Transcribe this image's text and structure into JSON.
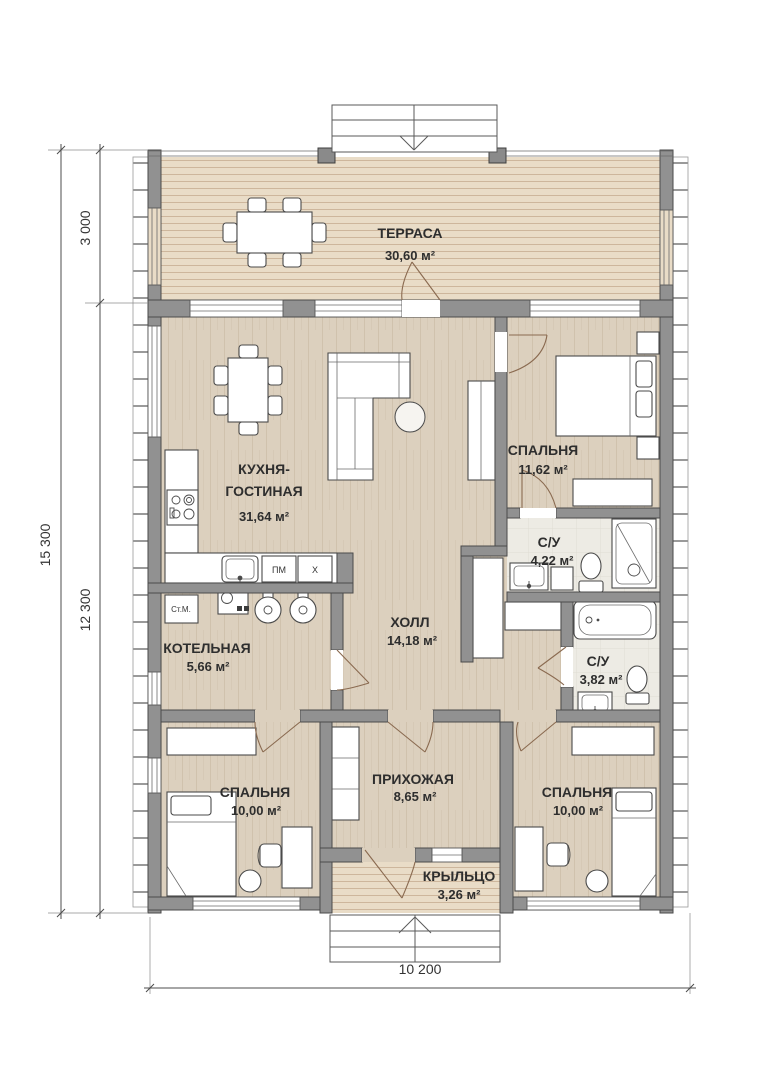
{
  "rooms": {
    "terrace": {
      "name": "ТЕРРАСА",
      "area": "30,60 м²"
    },
    "kitchen_living": {
      "name_line1": "КУХНЯ-",
      "name_line2": "ГОСТИНАЯ",
      "area": "31,64 м²"
    },
    "bedroom_master": {
      "name": "СПАЛЬНЯ",
      "area": "11,62 м²"
    },
    "bathroom_ensuite": {
      "name": "С/У",
      "area": "4,22 м²"
    },
    "hall": {
      "name": "ХОЛЛ",
      "area": "14,18 м²"
    },
    "boiler_room": {
      "name": "КОТЕЛЬНАЯ",
      "area": "5,66 м²"
    },
    "bathroom_main": {
      "name": "С/У",
      "area": "3,82 м²"
    },
    "bedroom_left": {
      "name": "СПАЛЬНЯ",
      "area": "10,00 м²"
    },
    "entry_hall": {
      "name": "ПРИХОЖАЯ",
      "area": "8,65 м²"
    },
    "bedroom_right": {
      "name": "СПАЛЬНЯ",
      "area": "10,00 м²"
    },
    "porch": {
      "name": "КРЫЛЬЦО",
      "area": "3,26 м²"
    }
  },
  "dimensions": {
    "overall_depth": "15 300",
    "terrace_depth": "3 000",
    "main_depth": "12 300",
    "overall_width": "10 200"
  },
  "appliances": {
    "dishwasher": "ПМ",
    "fridge": "Х",
    "washing_machine": "Ст.М."
  },
  "colors": {
    "wall": "#919191",
    "wall_stroke": "#4a4a4a",
    "wood_floor": "#dcd0be",
    "deck": "#e9dcc7",
    "tile": "#edebe4",
    "door_arc": "#8a6a50"
  }
}
